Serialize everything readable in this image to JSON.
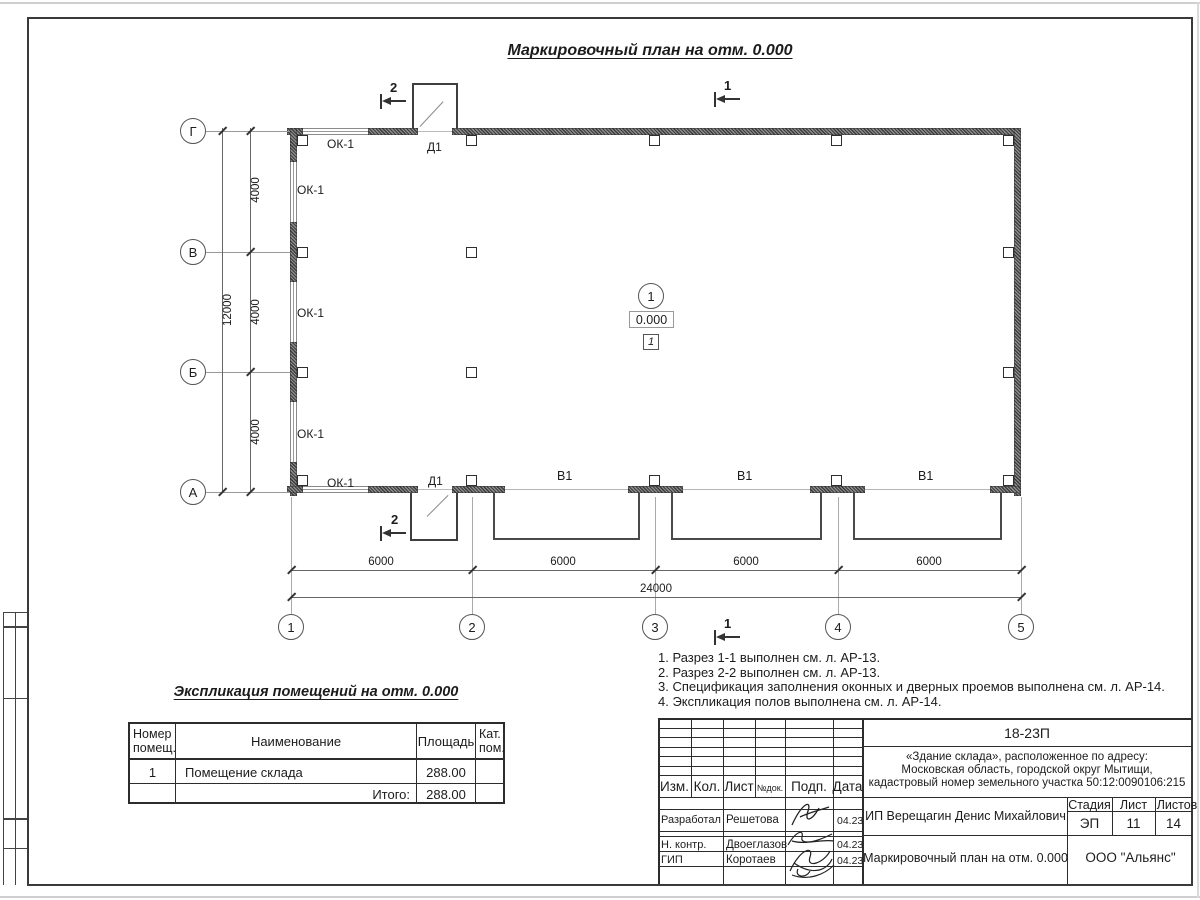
{
  "sheet": {
    "plan_title": "Маркировочный план на отм. 0.000",
    "grid": {
      "row_axes": [
        "Г",
        "В",
        "Б",
        "А"
      ],
      "col_axes": [
        "1",
        "2",
        "3",
        "4",
        "5"
      ],
      "row_dims": [
        "4000",
        "4000",
        "4000"
      ],
      "row_total": "12000",
      "col_dims": [
        "6000",
        "6000",
        "6000",
        "6000"
      ],
      "col_total": "24000"
    },
    "marks": {
      "window": "ОК-1",
      "door": "Д1",
      "gate": "В1",
      "section_1": "1",
      "section_2": "2",
      "room_number": "1",
      "elevation": "0.000",
      "floor_mark": "1"
    },
    "notes": [
      "1. Разрез 1-1 выполнен см. л. АР-13.",
      "2. Разрез 2-2 выполнен см. л. АР-13.",
      "3. Спецификация заполнения оконных и дверных проемов выполнена см. л. АР-14.",
      "4. Экспликация полов выполнена см. л. АР-14."
    ],
    "schedule": {
      "title": "Экспликация помещений на отм. 0.000",
      "col_room": "Номер\nпомещ.",
      "col_name": "Наименование",
      "col_area": "Площадь",
      "col_cat": "Кат.\nпом.",
      "row": {
        "number": "1",
        "name": "Помещение склада",
        "area": "288.00",
        "cat": ""
      },
      "total_label": "Итого:",
      "total_area": "288.00"
    },
    "titleblock": {
      "doc_number": "18-23П",
      "object_lines": [
        "«Здание склада», расположенное по адресу:",
        "Московская область, городской округ Мытищи,",
        "кадастровый номер земельного участка 50:12:0090106:215"
      ],
      "client": "ИП Верещагин Денис Михайлович",
      "sheet_name": "Маркировочный план на отм. 0.000",
      "company": "ООО \"Альянс\"",
      "stage_label": "Стадия",
      "sheet_label": "Лист",
      "sheets_label": "Листов",
      "stage": "ЭП",
      "sheet_num": "11",
      "sheets_total": "14",
      "rev_cols": [
        "Изм.",
        "Кол.",
        "Лист",
        "№док.",
        "Подп.",
        "Дата"
      ],
      "signers": [
        {
          "role": "Разработал",
          "name": "Решетова",
          "date": "04.23"
        },
        {
          "role": "Н. контр.",
          "name": "Двоеглазов",
          "date": "04.23"
        },
        {
          "role": "ГИП",
          "name": "Коротаев",
          "date": "04.23"
        }
      ]
    }
  }
}
